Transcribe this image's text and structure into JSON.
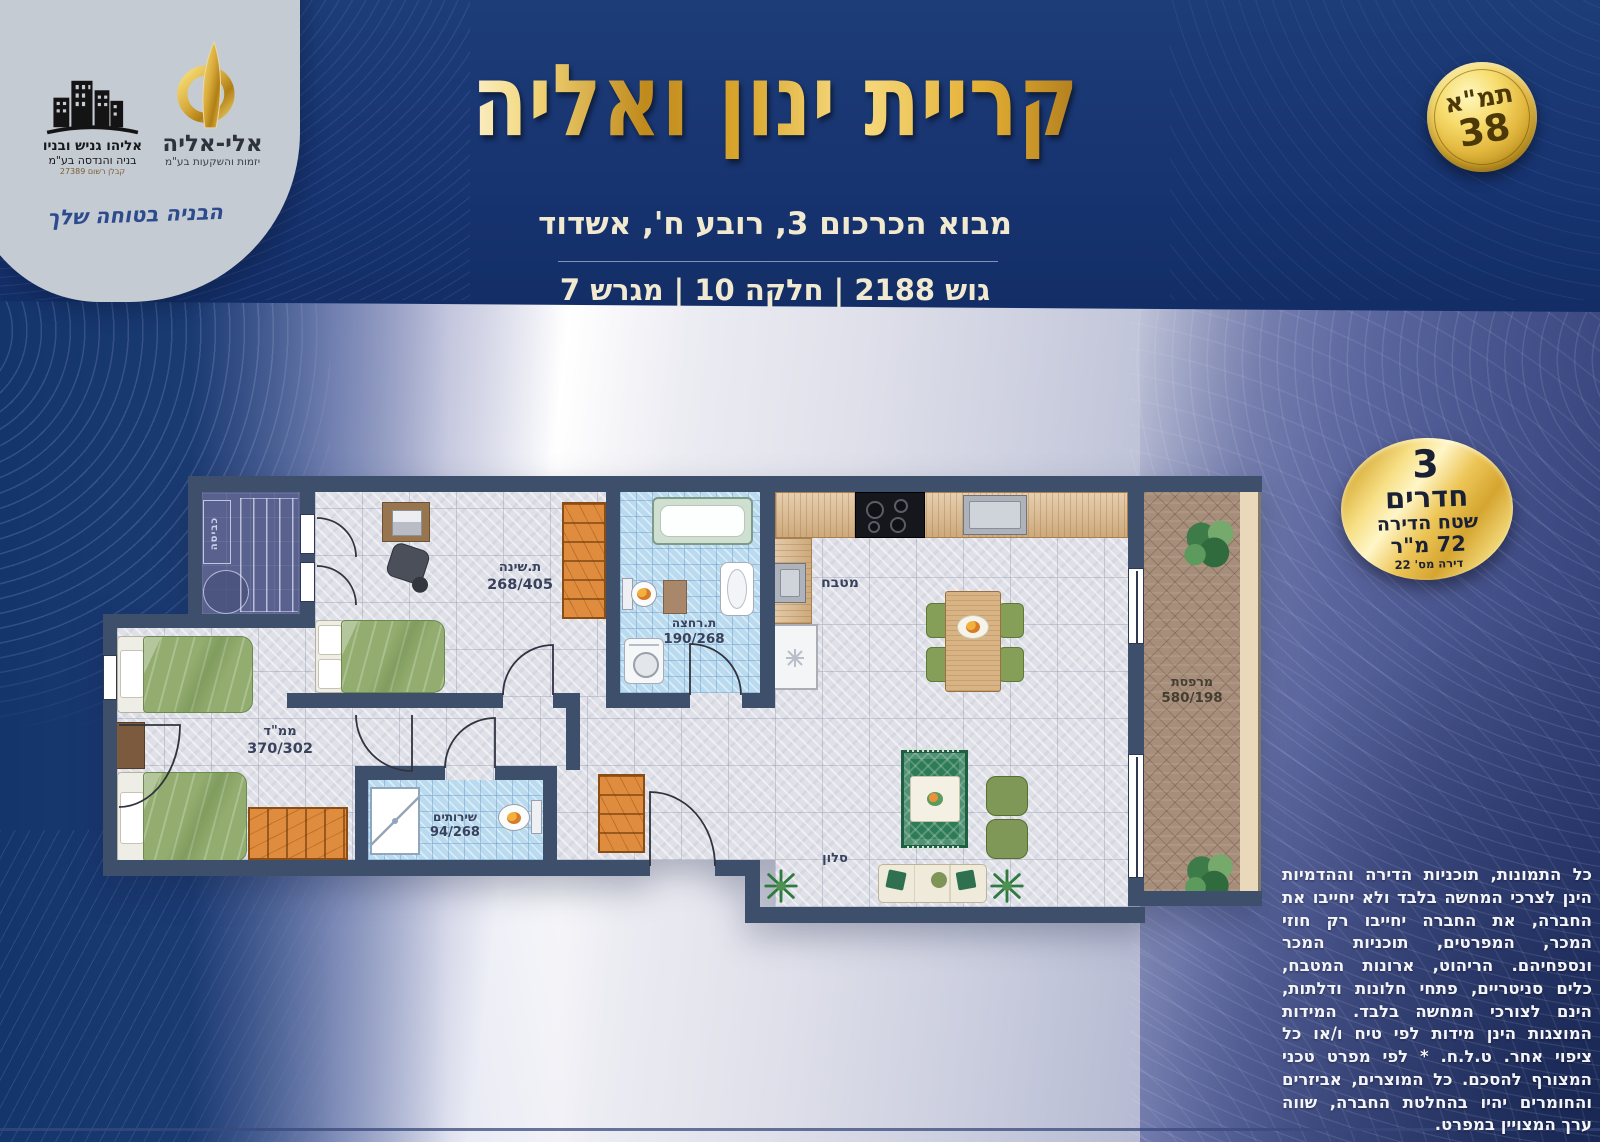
{
  "header": {
    "title": "קריית ינון ואליה",
    "address": "מבוא הכרכום 3, רובע ח', אשדוד",
    "parcel": "גוש 2188 | חלקה 10 | מגרש 7"
  },
  "tama_badge": {
    "line1": "תמ\"א",
    "line2": "38"
  },
  "apartment_badge": {
    "rooms_count": "3",
    "rooms_word": "חדרים",
    "area_label": "שטח הדירה",
    "area_value": "72 מ\"ר",
    "unit_number": "דירה מס' 22"
  },
  "logos": {
    "builder_name": "אליהו גניש ובניו",
    "builder_subtitle": "בניה והנדסה בע\"מ",
    "builder_license": "קבלן רשום 27389",
    "developer_name": "אלי-אליה",
    "developer_subtitle": "יזמות והשקעות בע\"מ",
    "slogan": "הבניה בטוחה שלך"
  },
  "plan": {
    "rooms": [
      {
        "name": "ת.שינה",
        "dims": "268/405"
      },
      {
        "name": "ת.רחצה",
        "dims": "190/268"
      },
      {
        "name": "מטבח",
        "dims": ""
      },
      {
        "name": "ממ\"ד",
        "dims": "370/302"
      },
      {
        "name": "שירותים",
        "dims": "94/268"
      },
      {
        "name": "סלון",
        "dims": ""
      },
      {
        "name": "מרפסת",
        "dims": "580/198"
      },
      {
        "name": "כביסה",
        "dims": ""
      }
    ]
  },
  "disclaimer": {
    "text": "כל התמונות, תוכניות הדירה וההדמיות הינן לצרכי המחשה בלבד ולא יחייבו את החברה, את החברה יחייבו רק חוזי המכר, המפרטים, תוכניות המכר ונספחיהם. הריהוט, ארונות המטבח, כלים סניטריים, פתחי חלונות ודלתות, הינם לצורכי המחשה בלבד. המידות המוצגות הינן מידות לפי טיח ו/או כל ציפוי אחר. ט.ל.ח. * לפי מפרט טכני המצורף להסכם. כל המוצרים, אביזרים והחומרים יהיו בהחלטת החברה, שווה ערך המצויין במפרט."
  }
}
